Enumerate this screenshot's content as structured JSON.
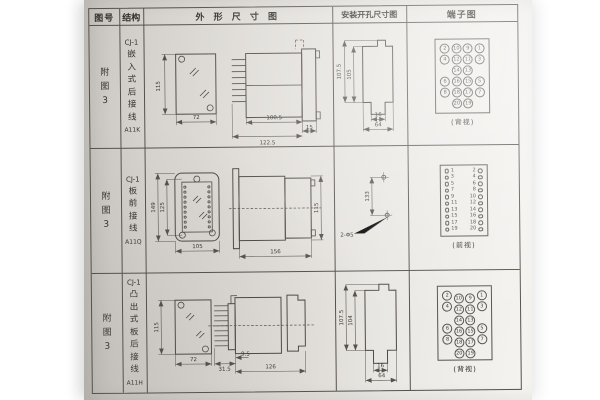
{
  "colors": {
    "ink": "#3a3733",
    "paper": "#e0ddd8",
    "table_line": "#55514b"
  },
  "table": {
    "headers": {
      "figure_no": "图号",
      "structure": "结构",
      "outline": "外 形 尺 寸 图",
      "install": "安装开孔尺寸图",
      "terminal": "端子图"
    }
  },
  "rows": [
    {
      "figure_no": "附图3",
      "model": "CJ-1",
      "mounting": "嵌入式后接线",
      "code": "A11K",
      "outline_dims": {
        "height": "115",
        "width": "72",
        "body_depth": "100.5",
        "total_depth": "122.5",
        "flange": "15"
      },
      "install_dims": {
        "outer_height": "107.5",
        "inner_height": "105",
        "slot_width": "16",
        "opening_width": "64"
      },
      "terminal": {
        "view_label": "(背视)",
        "grid": [
          [
            "2",
            "10",
            "9",
            "1"
          ],
          [
            "4",
            "12",
            "11",
            "3"
          ],
          [
            "",
            "14",
            "13",
            ""
          ],
          [
            "6",
            "16",
            "15",
            "5"
          ],
          [
            "8",
            "18",
            "17",
            "7"
          ],
          [
            "",
            "20",
            "19",
            ""
          ]
        ]
      }
    },
    {
      "figure_no": "附图3",
      "model": "CJ-1",
      "mounting": "板前接线",
      "code": "A11Q",
      "outline_dims": {
        "height_outer": "149",
        "height_inner": "125",
        "width": "105",
        "depth": "156",
        "side_height": "115"
      },
      "install_dims": {
        "hole_spacing": "133",
        "holes": "2-Φ5"
      },
      "terminal": {
        "view_label": "(前视)",
        "pairs": [
          [
            "1",
            "2"
          ],
          [
            "3",
            "4"
          ],
          [
            "5",
            "6"
          ],
          [
            "7",
            "8"
          ],
          [
            "9",
            "10"
          ],
          [
            "11",
            "12"
          ],
          [
            "13",
            "14"
          ],
          [
            "15",
            "16"
          ],
          [
            "17",
            "18"
          ],
          [
            "19",
            "20"
          ]
        ]
      }
    },
    {
      "figure_no": "附图3",
      "model": "CJ-1",
      "mounting": "凸出式板后接线",
      "code": "A11H",
      "outline_dims": {
        "height": "115",
        "width": "72",
        "pin_depth": "31.5",
        "offset": "9.5",
        "total_depth": "126"
      },
      "install_dims": {
        "outer_height": "107.5",
        "inner_height": "104",
        "slot_width": "16",
        "opening_width": "64"
      },
      "terminal": {
        "view_label": "(背视)",
        "grid": [
          [
            "2",
            "10",
            "9",
            "1"
          ],
          [
            "4",
            "12",
            "11",
            "3"
          ],
          [
            "",
            "14",
            "13",
            ""
          ],
          [
            "6",
            "16",
            "15",
            "5"
          ],
          [
            "8",
            "18",
            "17",
            "7"
          ],
          [
            "",
            "20",
            "19",
            ""
          ]
        ]
      }
    }
  ]
}
